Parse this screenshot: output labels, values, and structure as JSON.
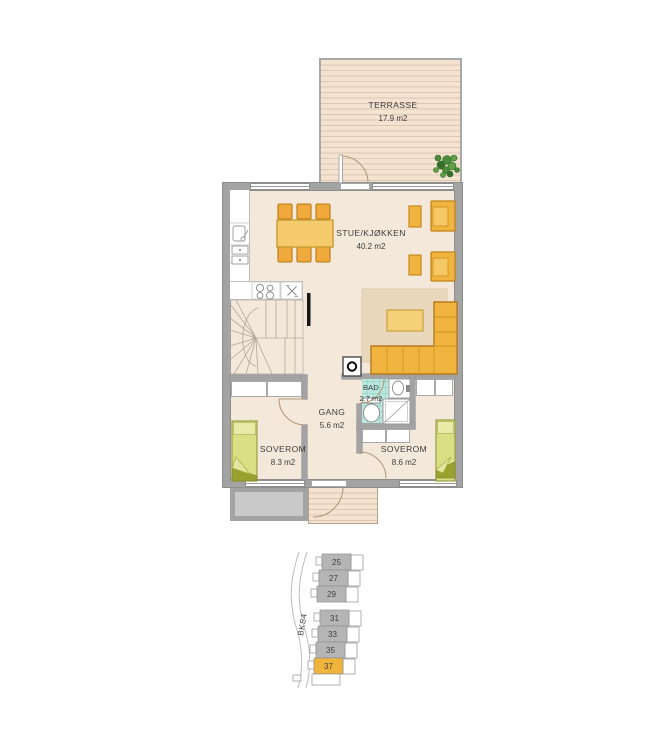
{
  "floorplan": {
    "terrasse": {
      "name": "TERRASSE",
      "area": "17.9 m2"
    },
    "stue": {
      "name": "STUE/KJØKKEN",
      "area": "40.2 m2"
    },
    "bad": {
      "name": "BAD",
      "area": "2.7 m2"
    },
    "gang": {
      "name": "GANG",
      "area": "5.6 m2"
    },
    "soverom_left": {
      "name": "SOVEROM",
      "area": "8.3 m2"
    },
    "soverom_right": {
      "name": "SOVEROM",
      "area": "8.6 m2"
    }
  },
  "siteplan": {
    "block_label": "BKS4",
    "units": [
      {
        "number": "25",
        "highlighted": false
      },
      {
        "number": "27",
        "highlighted": false
      },
      {
        "number": "29",
        "highlighted": false
      },
      {
        "number": "31",
        "highlighted": false
      },
      {
        "number": "33",
        "highlighted": false
      },
      {
        "number": "35",
        "highlighted": false
      },
      {
        "number": "37",
        "highlighted": true
      }
    ]
  },
  "colors": {
    "wall": "#a3a3a3",
    "floor": "#f3e8da",
    "deck": "#f4e3d1",
    "furniture": "#f1b53f",
    "bed": "#dade85",
    "bathroom": "#bce8df",
    "site_unit_gray": "#b5b5b5",
    "site_highlight": "#f0b43c"
  }
}
